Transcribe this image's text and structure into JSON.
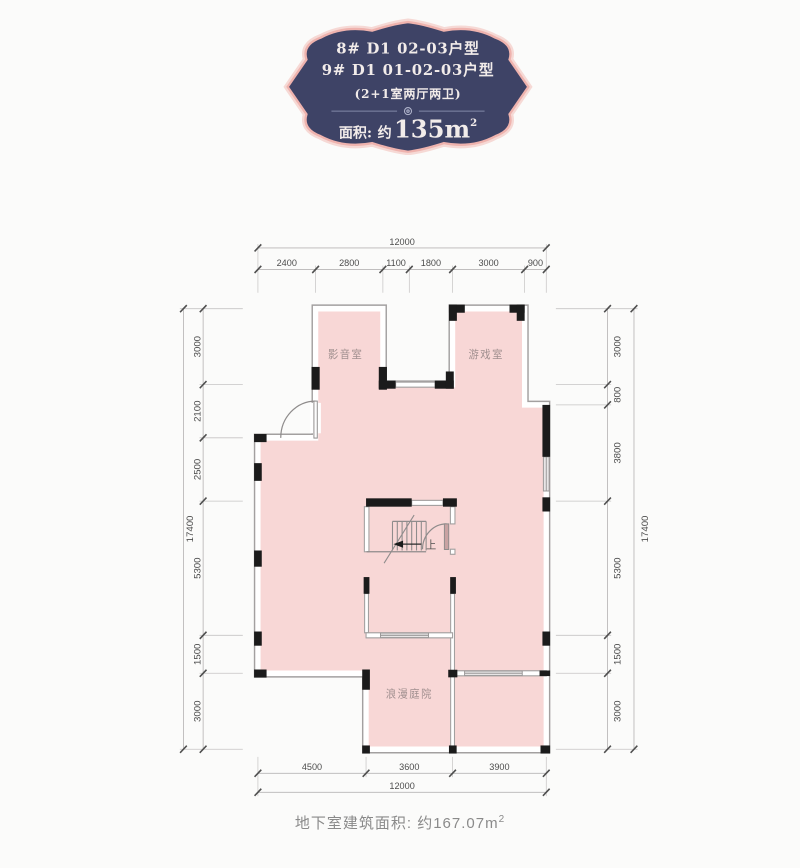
{
  "badge": {
    "line1": "8#  D1  02-03户型",
    "line2": "9#  D1  01-02-03户型",
    "line3": "(2+1室两厅两卫)",
    "area_label": "面积:",
    "area_approx": "约",
    "area_value": "135m",
    "area_sup": "2"
  },
  "plan": {
    "rooms": [
      {
        "name": "影音室"
      },
      {
        "name": "游戏室"
      },
      {
        "name": "浪漫庭院"
      }
    ],
    "stair_label": "上",
    "dims": {
      "top": {
        "overall": "12000",
        "segments": [
          "2400",
          "2800",
          "1100",
          "1800",
          "3000",
          "900"
        ]
      },
      "bottom": {
        "overall": "12000",
        "segments": [
          "4500",
          "3600",
          "3900"
        ]
      },
      "left": {
        "overall": "17400",
        "segments": [
          "3000",
          "2100",
          "2500",
          "5300",
          "1500",
          "3000"
        ]
      },
      "right": {
        "overall": "17400",
        "segments": [
          "3000",
          "800",
          "3800",
          "5300",
          "1500",
          "3000"
        ]
      }
    }
  },
  "caption": {
    "prefix": "地下室建筑面积: 约",
    "value": "167.07m",
    "sup": "2"
  },
  "colors": {
    "floor_fill": "#f8d7d6",
    "wall_line": "#a3a0a0",
    "column_black": "#1b1b1b",
    "window_fill": "#e8e6e6",
    "door_leaf": "#c9a3a3",
    "badge_background": "#3e4366",
    "badge_border": "#efb3ae",
    "badge_text": "#f2ecea",
    "dim_text": "#4d4d4d",
    "room_label": "#a08f8f",
    "caption_text": "#8a8a8a"
  }
}
